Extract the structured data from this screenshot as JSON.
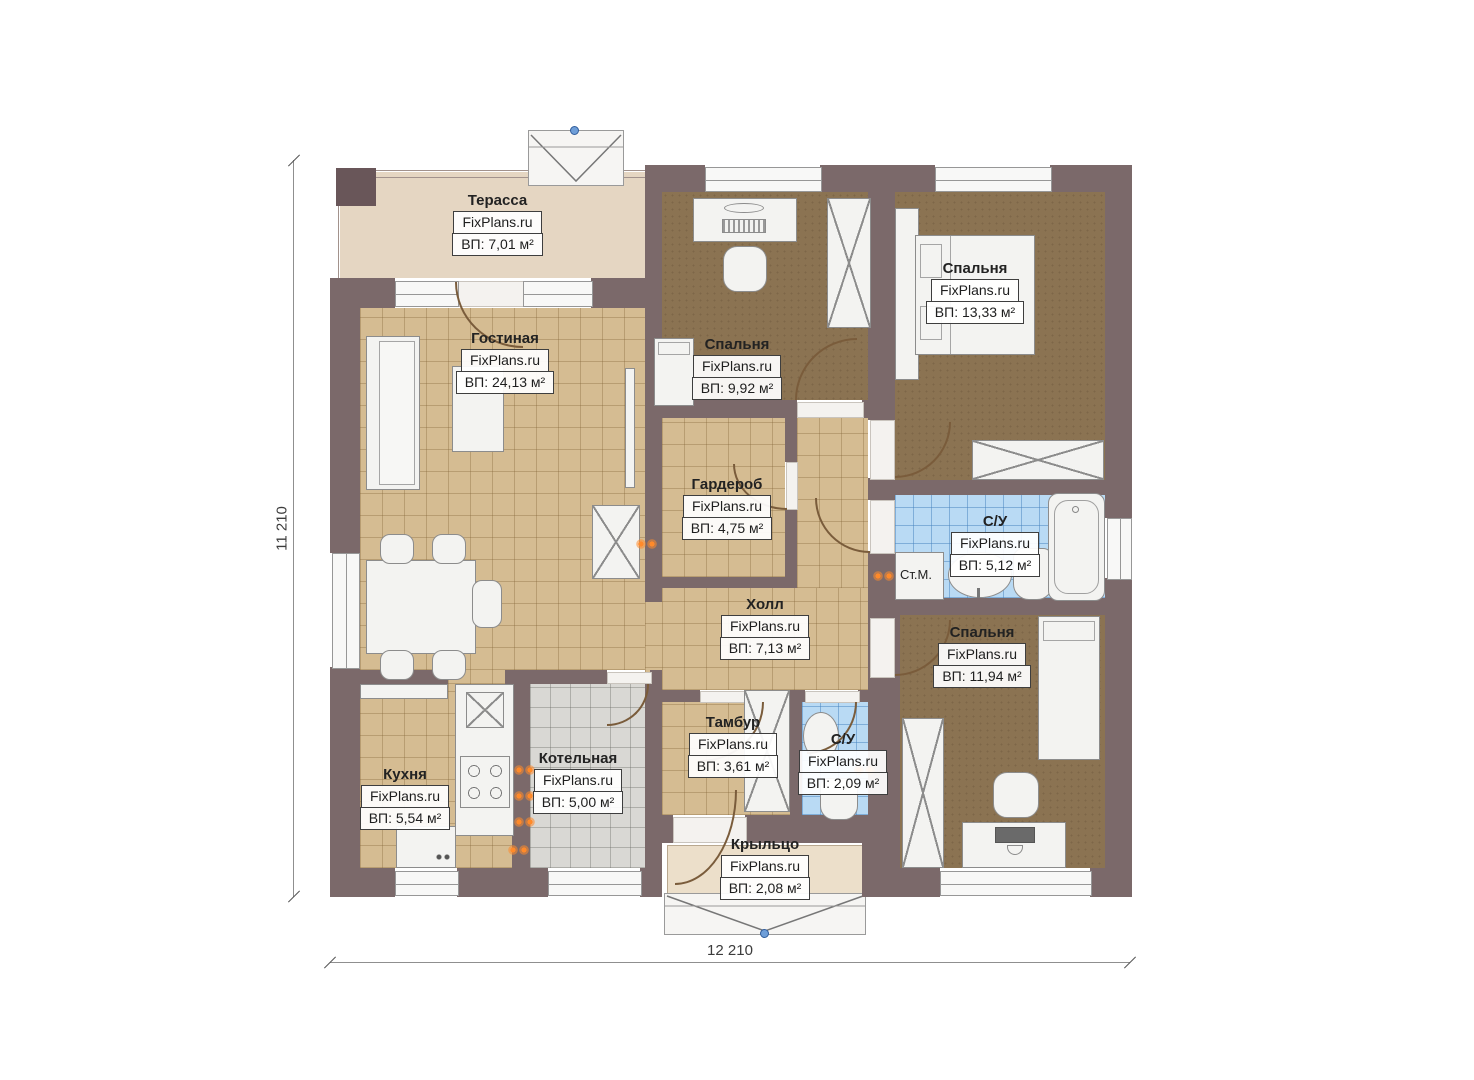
{
  "plan": {
    "brand": "FixPlans.ru",
    "dimensions": {
      "height_label": "11 210",
      "width_label": "12 210"
    },
    "rooms": [
      {
        "key": "terrace",
        "name": "Терасса",
        "brand": "FixPlans.ru",
        "area": "ВП: 7,01 м²"
      },
      {
        "key": "living",
        "name": "Гостиная",
        "brand": "FixPlans.ru",
        "area": "ВП: 24,13 м²"
      },
      {
        "key": "bedroom-top",
        "name": "Спальня",
        "brand": "FixPlans.ru",
        "area": "ВП: 9,92 м²"
      },
      {
        "key": "bedroom-right",
        "name": "Спальня",
        "brand": "FixPlans.ru",
        "area": "ВП: 13,33 м²"
      },
      {
        "key": "wardrobe",
        "name": "Гардероб",
        "brand": "FixPlans.ru",
        "area": "ВП: 4,75 м²"
      },
      {
        "key": "bathroom-main",
        "name": "С/У",
        "brand": "FixPlans.ru",
        "area": "ВП: 5,12 м²"
      },
      {
        "key": "hall",
        "name": "Холл",
        "brand": "FixPlans.ru",
        "area": "ВП: 7,13 м²"
      },
      {
        "key": "bedroom-bottom",
        "name": "Спальня",
        "brand": "FixPlans.ru",
        "area": "ВП: 11,94 м²"
      },
      {
        "key": "kitchen",
        "name": "Кухня",
        "brand": "FixPlans.ru",
        "area": "ВП: 5,54 м²"
      },
      {
        "key": "boiler",
        "name": "Котельная",
        "brand": "FixPlans.ru",
        "area": "ВП: 5,00 м²"
      },
      {
        "key": "vestibule",
        "name": "Тамбур",
        "brand": "FixPlans.ru",
        "area": "ВП: 3,61 м²"
      },
      {
        "key": "bathroom-small",
        "name": "С/У",
        "brand": "FixPlans.ru",
        "area": "ВП: 2,09 м²"
      },
      {
        "key": "porch",
        "name": "Крыльцо",
        "brand": "FixPlans.ru",
        "area": "ВП: 2,08 м²"
      }
    ],
    "labels": {
      "washing_machine": "Ст.М."
    },
    "colors": {
      "wall": "#7b696a",
      "floor_tile": "#d5bc92",
      "floor_carpet": "#8b7352",
      "floor_bath": "#b9daf4",
      "floor_boiler": "#d9d8d4",
      "floor_terrace": "#e5d6c2",
      "floor_porch": "#ecdfca",
      "heat_marker": "#ff8a2a",
      "step_dot": "#6e9ed8"
    }
  }
}
